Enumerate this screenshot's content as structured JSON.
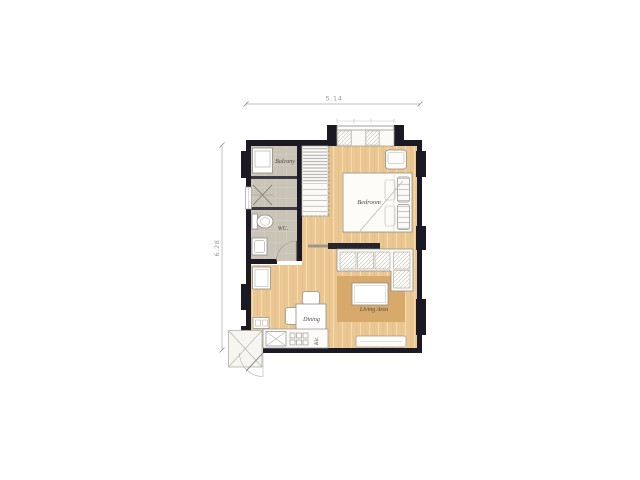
{
  "dimensions": {
    "width": "5.14",
    "height": "6.28"
  },
  "rooms": {
    "balcony": {
      "label": "Balcony"
    },
    "wc": {
      "label": "WC."
    },
    "bedroom": {
      "label": "Bedroom"
    },
    "living": {
      "label": "Living Area"
    },
    "dining": {
      "label": "Dining"
    },
    "kitchen": {
      "label": "Kit."
    }
  },
  "colors": {
    "wall": "#1b1a24",
    "wood_floor": "#ebc893",
    "wood_grain_light": "#f5dcab",
    "wood_grain_dark": "#ddb67c",
    "tile_floor": "#c9c4b6",
    "rug": "#d7a96b",
    "furniture_fill": "#fdfcf9",
    "furniture_outline": "#8f8c84",
    "divider": "#3a3a42",
    "dimension_line": "#aaaaaa"
  }
}
